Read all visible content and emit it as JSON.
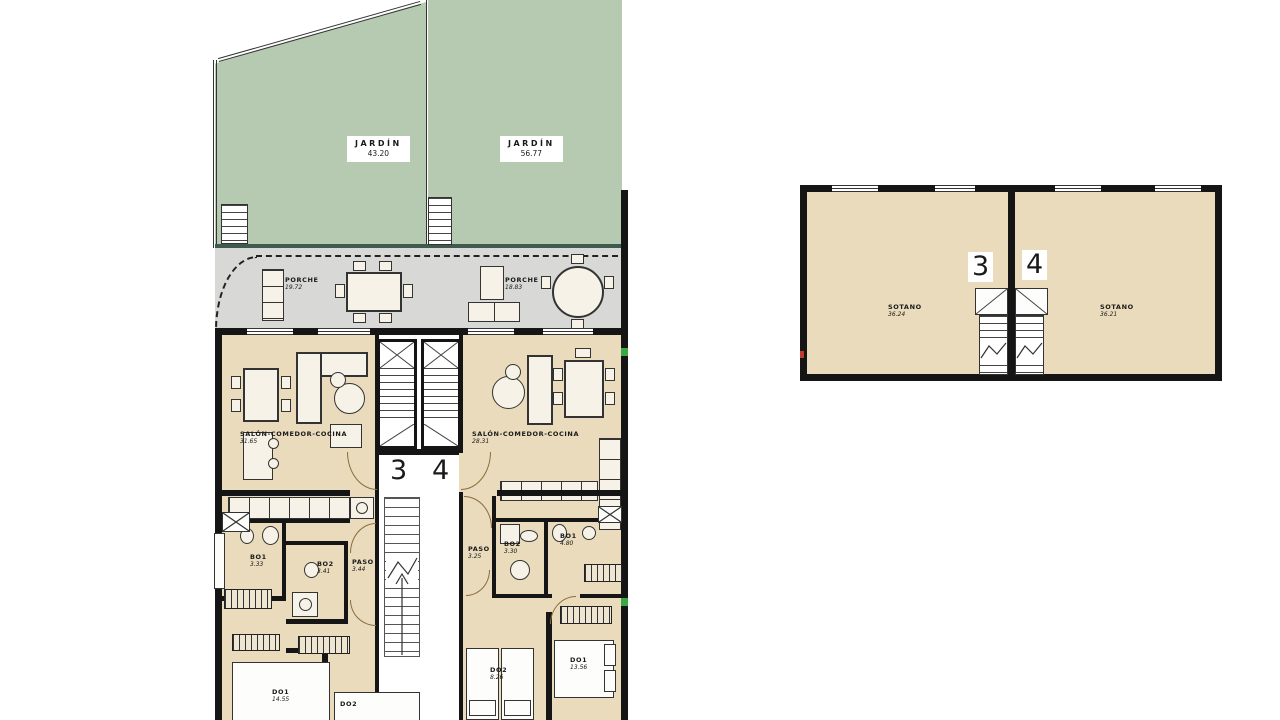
{
  "colors": {
    "garden": "#b6c9b1",
    "porch": "#d8d9d6",
    "interior": "#e9dbbc",
    "wall": "#151515",
    "mark_green": "#39a845",
    "mark_red": "#c23a2b"
  },
  "floor_plan": {
    "gardens": [
      {
        "name": "JARDÍN",
        "area": "43.20"
      },
      {
        "name": "JARDÍN",
        "area": "56.77"
      }
    ],
    "porches": [
      {
        "name": "PORCHE",
        "area": "19.72"
      },
      {
        "name": "PORCHE",
        "area": "18.83"
      }
    ],
    "units": [
      {
        "number": "3",
        "salon": {
          "name": "SALÓN-COMEDOR-COCINA",
          "area": "31.65"
        },
        "rooms": [
          {
            "name": "BO1",
            "area": "3.33"
          },
          {
            "name": "BO2",
            "area": "3.41"
          },
          {
            "name": "PASO",
            "area": "3.44"
          },
          {
            "name": "DO1",
            "area": "14.55"
          },
          {
            "name": "DO2",
            "area": ""
          }
        ]
      },
      {
        "number": "4",
        "salon": {
          "name": "SALÓN-COMEDOR-COCINA",
          "area": "28.31"
        },
        "rooms": [
          {
            "name": "PASO",
            "area": "3.25"
          },
          {
            "name": "BO2",
            "area": "3.30"
          },
          {
            "name": "BO1",
            "area": "4.80"
          },
          {
            "name": "DO2",
            "area": "8.26"
          },
          {
            "name": "DO1",
            "area": "13.56"
          }
        ]
      }
    ]
  },
  "basement_plan": {
    "units": [
      {
        "number": "3",
        "room": {
          "name": "SOTANO",
          "area": "36.24"
        }
      },
      {
        "number": "4",
        "room": {
          "name": "SOTANO",
          "area": "36.21"
        }
      }
    ]
  }
}
